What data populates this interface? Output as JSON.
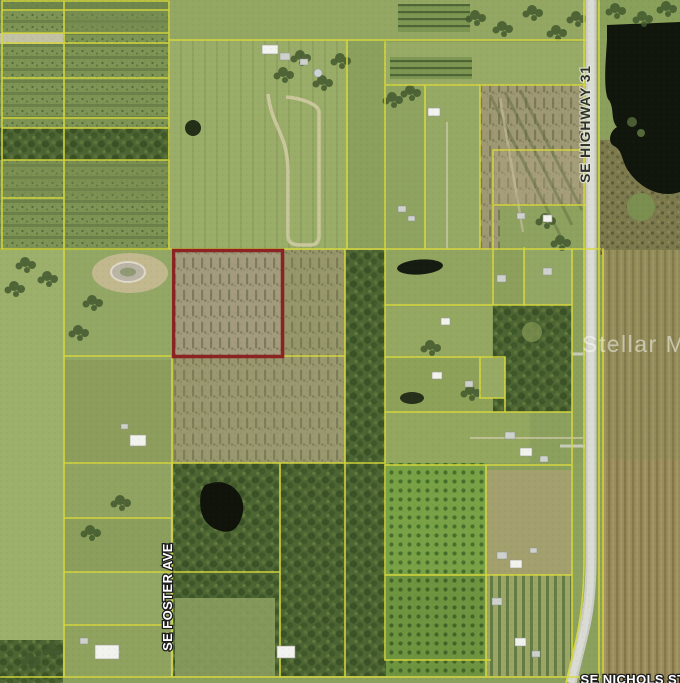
{
  "map": {
    "labels": {
      "highway": "SE HIGHWAY 31",
      "foster_ave": "SE FOSTER AVE",
      "nichols_st": "SE NICHOLS ST"
    },
    "watermark": "Stellar MLS",
    "colors": {
      "parcel_line": "#d8d83c",
      "highlight_outline": "#8b2323",
      "road": "#c9ccc5",
      "lake": "#11160c",
      "watermark": "#ffffff"
    }
  }
}
